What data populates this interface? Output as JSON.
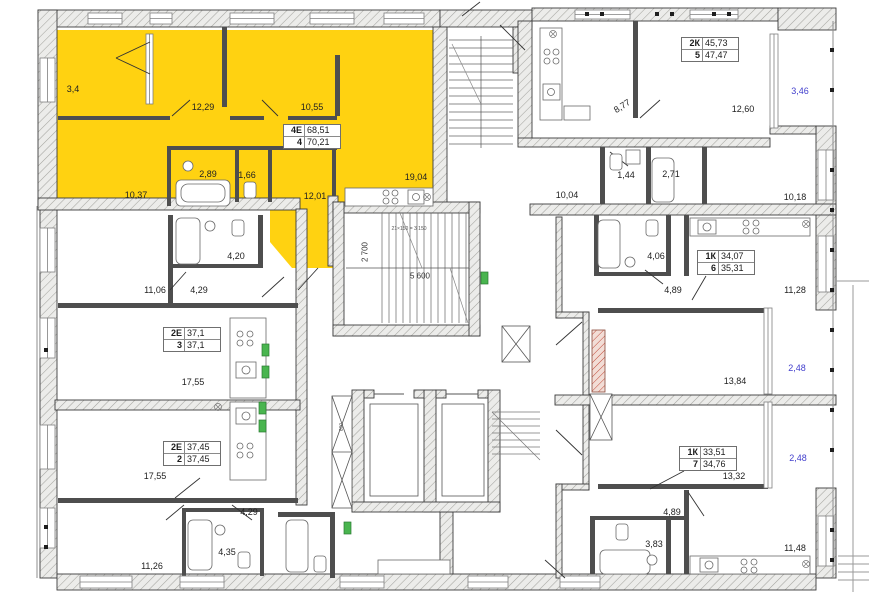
{
  "plan_title": "Residential floor plan with highlighted apartment",
  "colors": {
    "highlight": "#ffd211",
    "balcony_label": "#4340cd",
    "wall_fill": "#ececea",
    "green_box": "#49b54f",
    "red_shaft": "#c14b3a"
  },
  "apartments": [
    {
      "code": "4Е",
      "num": "4",
      "area1": "68,51",
      "area2": "70,21",
      "rooms": {
        "balcony": "3,4",
        "room1": "12,29",
        "room2": "10,55",
        "wardrobe": "2,89",
        "wc": "1,66",
        "room3": "10,37",
        "room4": "12,01",
        "kitchen_living": "19,04"
      }
    },
    {
      "code": "2К",
      "num": "5",
      "area1": "45,73",
      "area2": "47,47",
      "rooms": {
        "kitchen": "8,77",
        "room1": "12,60",
        "bath": "1,44",
        "wc": "2,71",
        "hall": "10,04",
        "room2": "10,18",
        "loggia": "3,46"
      }
    },
    {
      "code": "1К",
      "num": "6",
      "area1": "34,07",
      "area2": "35,31",
      "rooms": {
        "bath": "4,06",
        "hall": "4,89",
        "kitchen": "11,28",
        "room": "13,84",
        "loggia": "2,48"
      }
    },
    {
      "code": "1К",
      "num": "7",
      "area1": "33,51",
      "area2": "34,76",
      "rooms": {
        "room": "13,32",
        "hall": "4,89",
        "bath": "3,83",
        "kitchen": "11,48",
        "loggia": "2,48"
      }
    },
    {
      "code": "2Е",
      "num": "3",
      "area1": "37,1",
      "area2": "37,1",
      "rooms": {
        "room": "11,06",
        "bath": "4,20",
        "hall": "4,29",
        "kitchen_living": "17,55"
      }
    },
    {
      "code": "2Е",
      "num": "2",
      "area1": "37,45",
      "area2": "37,45",
      "rooms": {
        "kitchen_living": "17,55",
        "hall": "4,29",
        "bath": "4,35",
        "room": "11,26"
      }
    }
  ],
  "dimensions": {
    "stair_width": "2 700",
    "stair_run": "5 600",
    "stair_steps": "21×150 = 3 150",
    "shaft_width": "600"
  }
}
